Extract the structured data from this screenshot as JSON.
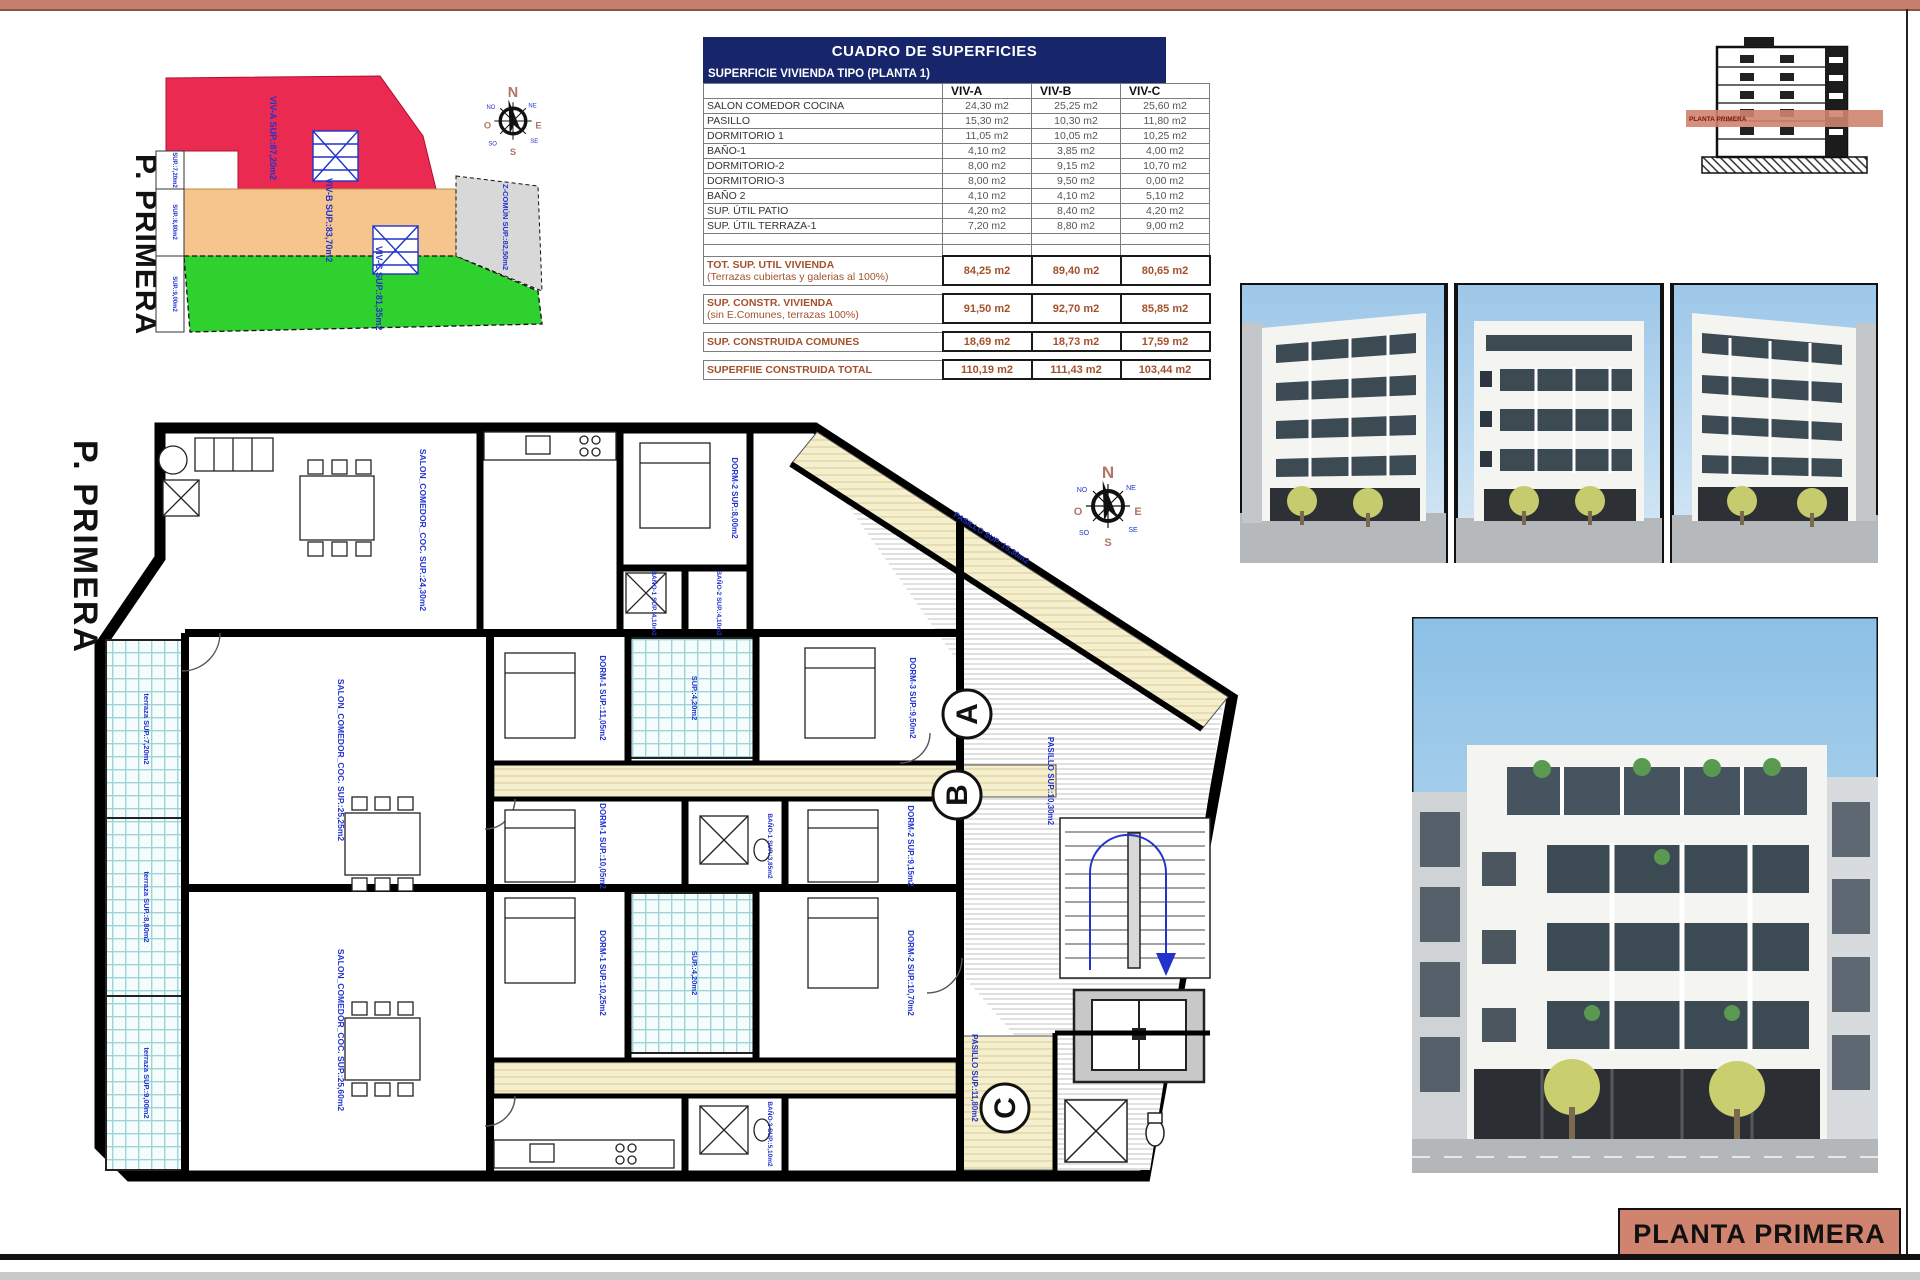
{
  "sheet": {
    "title_block": "PLANTA PRIMERA"
  },
  "key_plan": {
    "side_label": "P. PRIMERA",
    "viv_a": "VIV-A  SUP.:87,20m2",
    "viv_b": "VIV-B  SUP.:83,70m2",
    "viv_c": "VIV-C  SUP.:81,35m2",
    "zcomun": "Z-COMÚN  SUP.:82,50m2",
    "edge_1": "SUP.:7,20m2",
    "edge_2": "SUP.:8,80m2",
    "edge_3": "SUP.:9,00m2",
    "colors": {
      "viv_a": "#ea2a50",
      "viv_b": "#f6c58d",
      "viv_c": "#2ed12e",
      "zcomun": "#d8d8d8"
    }
  },
  "compass": {
    "n": "N",
    "e": "E",
    "s": "S",
    "o": "O",
    "ne": "NE",
    "se": "SE",
    "so": "SO",
    "no": "NO"
  },
  "section": {
    "band_label": "PLANTA PRIMERA"
  },
  "table": {
    "title": "CUADRO DE SUPERFICIES",
    "subtitle": "SUPERFICIE VIVIENDA TIPO  (PLANTA 1)",
    "cols": {
      "a": "VIV-A",
      "b": "VIV-B",
      "c": "VIV-C"
    },
    "rows": [
      {
        "label": "SALON COMEDOR COCINA",
        "a": "24,30 m2",
        "b": "25,25 m2",
        "c": "25,60 m2"
      },
      {
        "label": "PASILLO",
        "a": "15,30 m2",
        "b": "10,30 m2",
        "c": "11,80 m2"
      },
      {
        "label": "DORMITORIO 1",
        "a": "11,05 m2",
        "b": "10,05 m2",
        "c": "10,25 m2"
      },
      {
        "label": "BAÑO-1",
        "a": "4,10 m2",
        "b": "3,85 m2",
        "c": "4,00 m2"
      },
      {
        "label": "DORMITORIO-2",
        "a": "8,00 m2",
        "b": "9,15 m2",
        "c": "10,70 m2"
      },
      {
        "label": "DORMITORIO-3",
        "a": "8,00 m2",
        "b": "9,50 m2",
        "c": "0,00 m2"
      },
      {
        "label": "BAÑO 2",
        "a": "4,10 m2",
        "b": "4,10 m2",
        "c": "5,10 m2"
      },
      {
        "label": "SUP. ÚTIL PATIO",
        "a": "4,20 m2",
        "b": "8,40 m2",
        "c": "4,20 m2"
      },
      {
        "label": "SUP. ÚTIL TERRAZA-1",
        "a": "7,20 m2",
        "b": "8,80 m2",
        "c": "9,00 m2"
      }
    ],
    "totals": [
      {
        "label1": "TOT. SUP. UTIL VIVIENDA",
        "label2": "(Terrazas cubiertas y galerias al 100%)",
        "a": "84,25 m2",
        "b": "89,40 m2",
        "c": "80,65 m2"
      },
      {
        "label1": "SUP. CONSTR. VIVIENDA",
        "label2": "(sin E.Comunes, terrazas 100%)",
        "a": "91,50 m2",
        "b": "92,70 m2",
        "c": "85,85 m2"
      },
      {
        "label1": "SUP. CONSTRUIDA COMUNES",
        "label2": "",
        "a": "18,69 m2",
        "b": "18,73 m2",
        "c": "17,59 m2"
      },
      {
        "label1": "SUPERFIIE CONSTRUIDA TOTAL",
        "label2": "",
        "a": "110,19 m2",
        "b": "111,43 m2",
        "c": "103,44 m2"
      }
    ]
  },
  "plan": {
    "side_label": "P. PRIMERA",
    "circles": {
      "a": "A",
      "b": "B",
      "c": "C"
    },
    "labels": {
      "terraza_a": "terraza  SUP.:7,20m2",
      "terraza_b": "terraza  SUP.:8,80m2",
      "terraza_c": "terraza  SUP.:9,00m2",
      "salon_a": "SALON_COMEDOR_COC.  SUP.:24,30m2",
      "salon_b": "SALON_COMEDOR_COC.  SUP.:25,25m2",
      "salon_c": "SALON_COMEDOR_COC.  SUP.:25,60m2",
      "pasillo_a": "PASILLO  SUP.:15,30m2",
      "pasillo_b": "PASILLO  SUP.:10,30m2",
      "pasillo_c": "PASILLO  SUP.:11,80m2",
      "dorm1_a": "DORM-1  SUP.:11,05m2",
      "dorm2_a": "DORM-2  SUP.:8,00m2",
      "dorm1_b": "DORM-1  SUP.:10,05m2",
      "dorm2_b": "DORM-2  SUP.:9,15m2",
      "dorm3_b": "DORM-3  SUP.:9,50m2",
      "dorm1_c": "DORM-1  SUP.:10,25m2",
      "dorm2_c": "DORM-2  SUP.:10,70m2",
      "bano1_a": "BAÑO-1 SUP.:4,10m2",
      "bano2_a": "BAÑO-2 SUP.:4,10m2",
      "bano1_b": "BAÑO-1 SUP.:3,85m2",
      "bano2_c": "BAÑO-2 SUP.:5,10m2",
      "patio1": "SUP.:4,20m2",
      "patio2": "SUP.:4,20m2"
    }
  }
}
